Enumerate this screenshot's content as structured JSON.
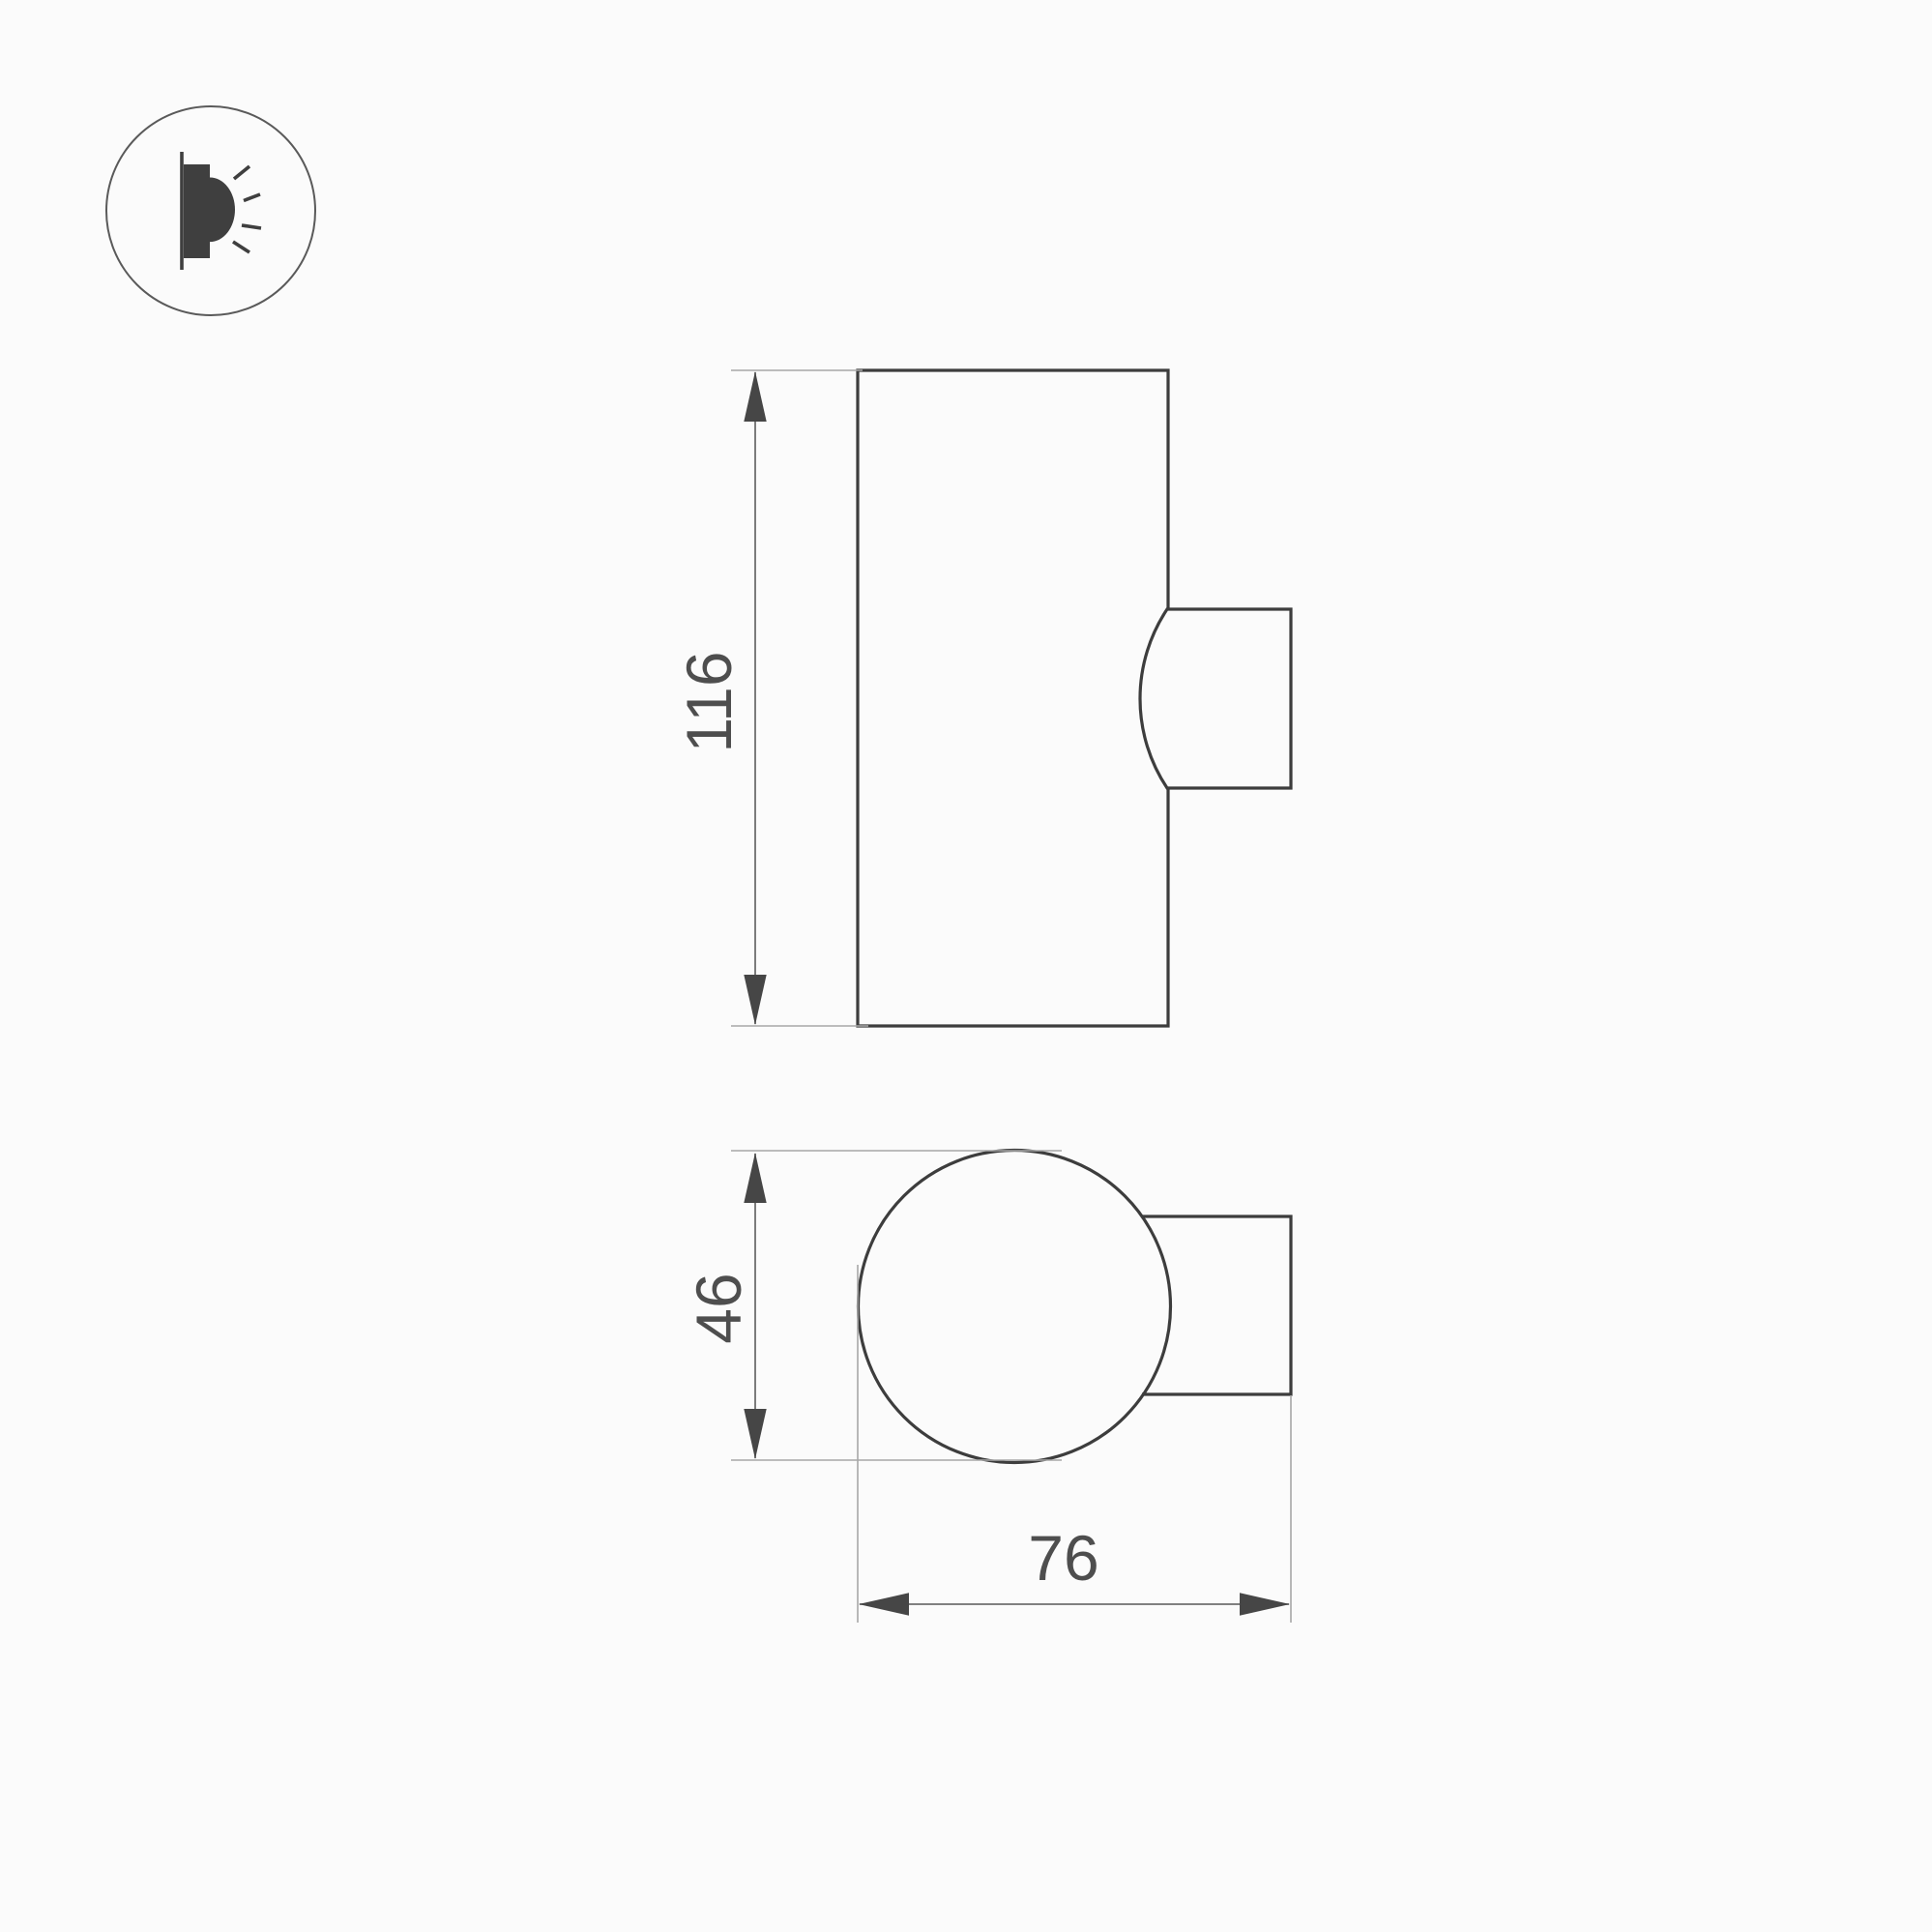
{
  "page": {
    "background": "#fbfbfb"
  },
  "icon": {
    "name": "wall-lamp-side-light-icon",
    "ring_color": "#5a5a5a",
    "glyph_color": "#3f3f3f"
  },
  "drawing": {
    "outline_color": "#3d3d3d",
    "dimension_line_color": "#6e6e6e",
    "extension_line_color": "#a8a8a8",
    "text_color": "#4e4e4e",
    "dimensions": {
      "height": "116",
      "diameter": "46",
      "depth": "76"
    }
  }
}
